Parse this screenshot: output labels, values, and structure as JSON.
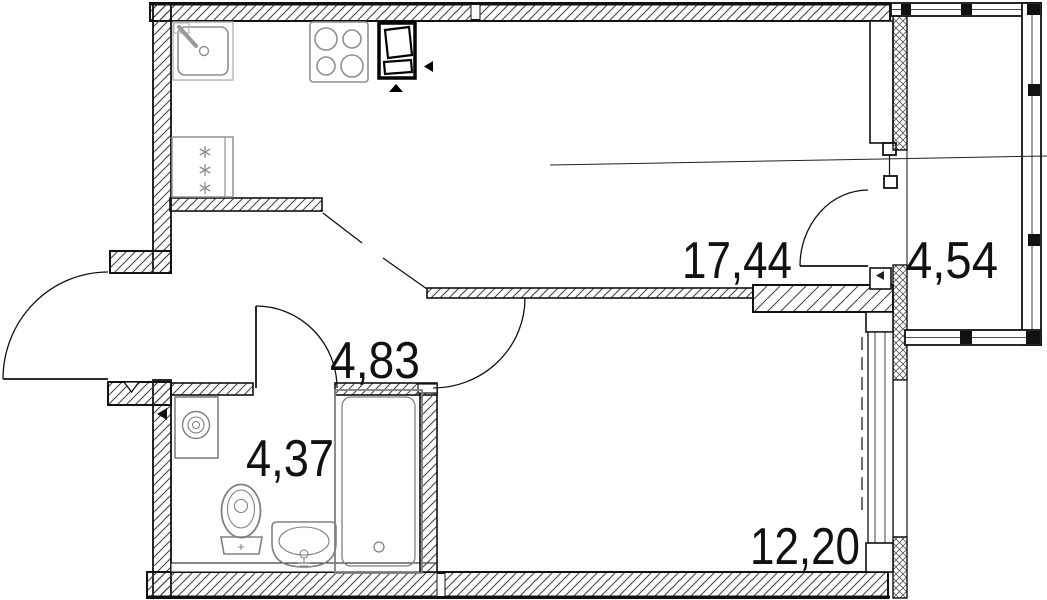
{
  "rooms": {
    "kitchen_living": {
      "area_label": "17,44"
    },
    "balcony": {
      "area_label": "4,54"
    },
    "hallway": {
      "area_label": "4,83"
    },
    "bathroom": {
      "area_label": "4,37"
    },
    "bedroom": {
      "area_label": "12,20"
    }
  },
  "fixtures": [
    "kitchen-sink-icon",
    "stove-icon",
    "ventilation-shaft-icon",
    "refrigerator-icon",
    "washing-machine-icon",
    "toilet-icon",
    "washbasin-icon",
    "bathtub-icon"
  ],
  "colors": {
    "wall_outline": "#111111",
    "hatch_line": "#3f3f3f",
    "fixture_gray": "#8f8f8f",
    "label_color": "#111111",
    "background": "#ffffff"
  }
}
